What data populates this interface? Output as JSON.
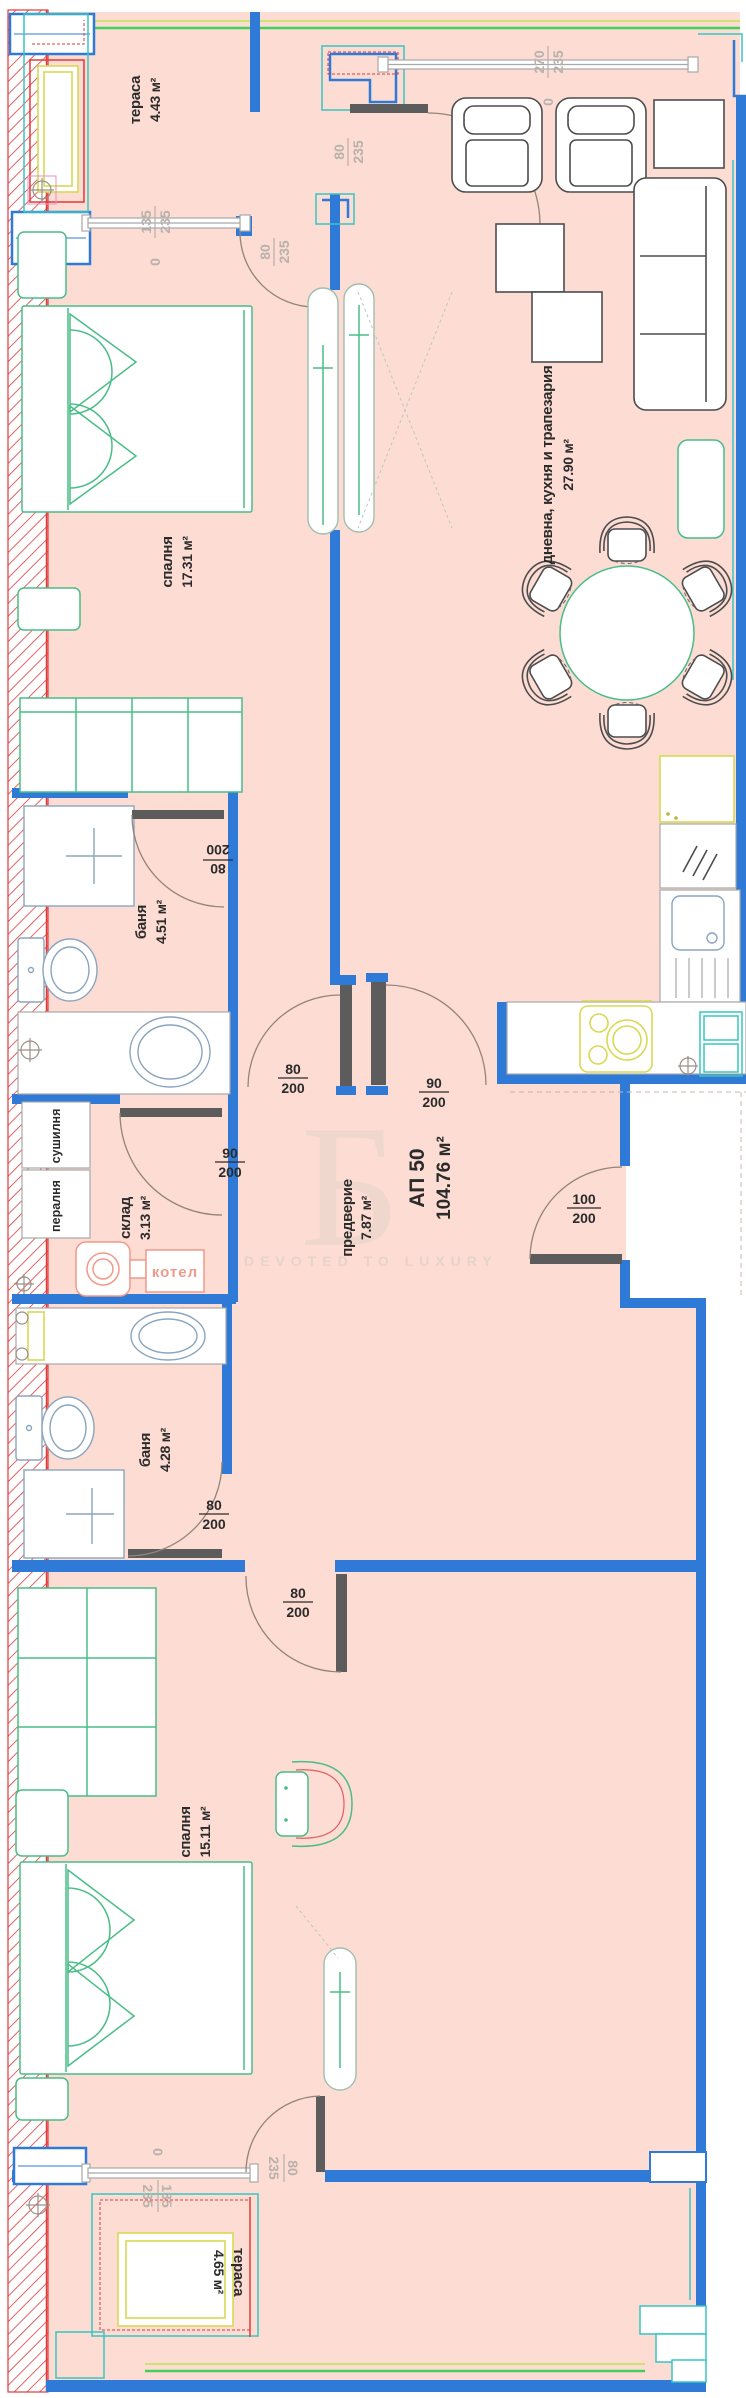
{
  "colors": {
    "floor": "#fcdcd3",
    "wall": "#2e7ad6",
    "teal": "#38c5c2",
    "green": "#49bd87",
    "rail": "#43cf5c",
    "raily": "#cde470",
    "yellow": "#d8d955",
    "red": "#e23a3a",
    "ink": "#2b2b2b",
    "dim": "#b8b1ac",
    "leaf": "#5c5c5c",
    "arc": "#938478",
    "salmon": "#f09a8a",
    "furn": "#4d4d4d",
    "wm": "#e3d2ca"
  },
  "apartment": {
    "id": "АП 50",
    "area": "104.76 м²"
  },
  "watermark": {
    "letter": "Б",
    "tagline": "DEVOTED TO LUXURY"
  },
  "rooms": {
    "terrace_top": {
      "name": "тераса",
      "area": "4.43 м²"
    },
    "bedroom1": {
      "name": "спалня",
      "area": "17.31 м²"
    },
    "living": {
      "name": "дневна, кухня и трапезария",
      "area": "27.90 м²"
    },
    "bath1": {
      "name": "баня",
      "area": "4.51 м²"
    },
    "storage": {
      "name": "склад",
      "area": "3.13 м²"
    },
    "hall": {
      "name": "предверие",
      "area": "7.87 м²"
    },
    "bath2": {
      "name": "баня",
      "area": "4.28 м²"
    },
    "bedroom2": {
      "name": "спалня",
      "area": "15.11 м²"
    },
    "terrace_bottom": {
      "name": "тераса",
      "area": "4.65 м²"
    }
  },
  "appliances": {
    "dryer": "сушилня",
    "washer": "пералня",
    "boiler": "котел"
  },
  "openings": {
    "win_terrace_top": {
      "w": "135",
      "h": "235",
      "zero": "0"
    },
    "door_terrace_bedroom": {
      "w": "80",
      "h": "235"
    },
    "door_terrace_living": {
      "w": "80",
      "h": "235"
    },
    "win_living": {
      "w": "270",
      "h": "235",
      "zero": "0"
    },
    "door_bath1": {
      "w": "80",
      "h": "200"
    },
    "door_hall_corridor": {
      "w": "80",
      "h": "200"
    },
    "door_storage": {
      "w": "90",
      "h": "200"
    },
    "door_kitchen": {
      "w": "90",
      "h": "200"
    },
    "door_entry": {
      "w": "100",
      "h": "200"
    },
    "door_bath2": {
      "w": "80",
      "h": "200"
    },
    "door_bedroom2": {
      "w": "80",
      "h": "200"
    },
    "win_terrace_bottom": {
      "w": "135",
      "h": "235",
      "zero": "0"
    },
    "door_terrace2": {
      "w": "80",
      "h": "235"
    }
  }
}
